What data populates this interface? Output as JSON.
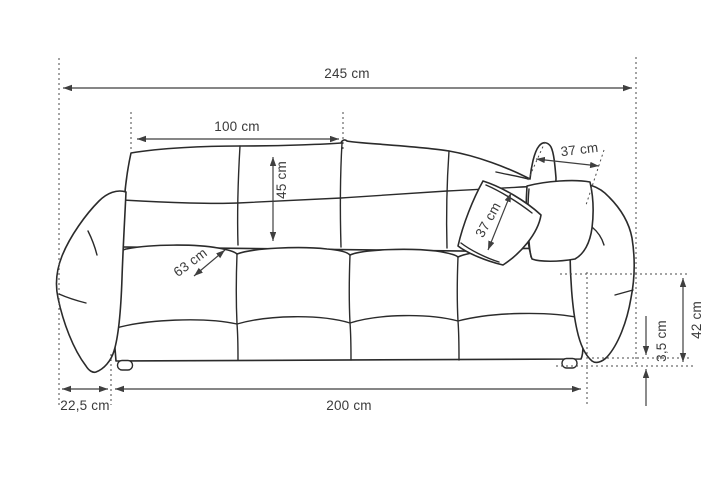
{
  "diagram": {
    "type": "dimension-drawing",
    "subject": "sofa",
    "unit": "cm",
    "background": "#ffffff",
    "colors": {
      "outline": "#2b2b2b",
      "dimension_line": "#3f3f3f",
      "extension_line": "#4a4a4a",
      "text": "#3a3a3a"
    }
  },
  "labels": {
    "total_width": "245 cm",
    "backrest_cushion_width": "100 cm",
    "backrest_cushion_height": "45 cm",
    "pillow_width": "37 cm",
    "pillow_height": "37 cm",
    "seat_depth": "63 cm",
    "armrest_width": "22,5 cm",
    "base_width": "200 cm",
    "seat_height": "42 cm",
    "leg_clearance_height": "3,5 cm"
  },
  "values": {
    "total_width_cm": 245,
    "backrest_cushion_width_cm": 100,
    "backrest_cushion_height_cm": 45,
    "pillow_width_cm": 37,
    "pillow_height_cm": 37,
    "seat_depth_cm": 63,
    "armrest_width_cm": 22.5,
    "base_width_cm": 200,
    "seat_height_cm": 42,
    "leg_clearance_height_cm": 3.5
  }
}
